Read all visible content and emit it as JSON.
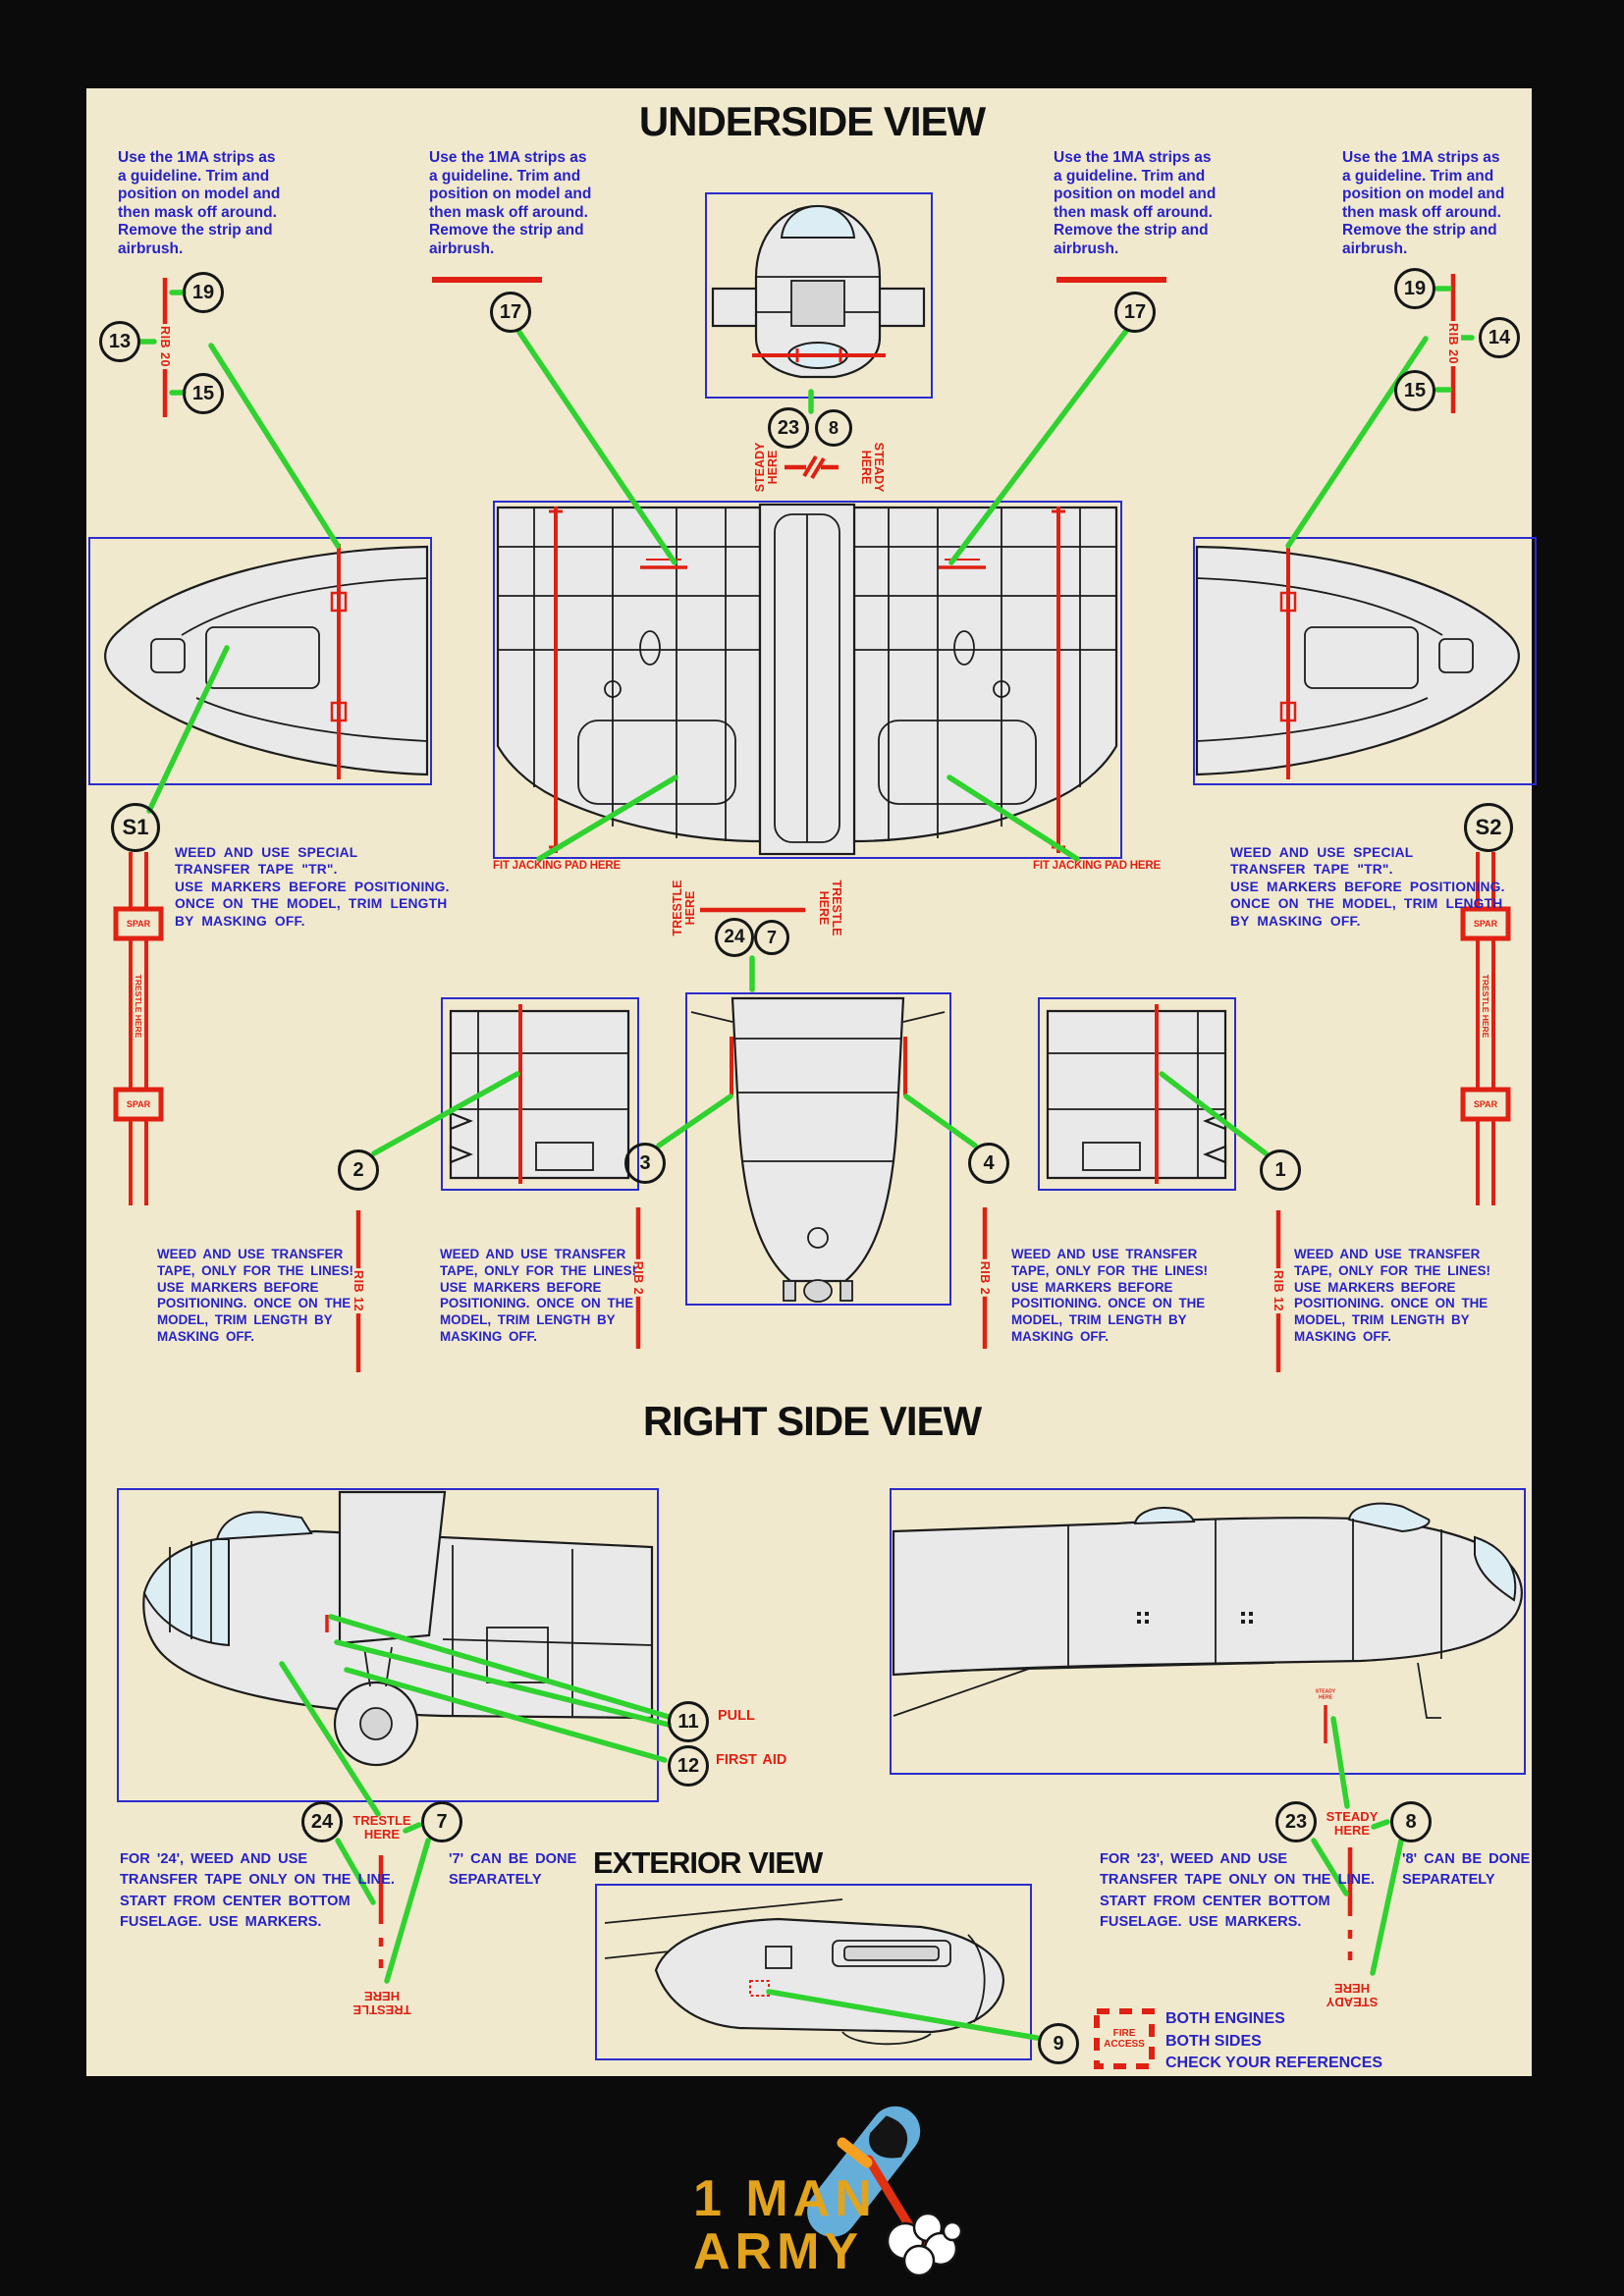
{
  "colors": {
    "paper": "#f0e9ce",
    "blue_text": "#2822c6",
    "box_border": "#2b2bcd",
    "red": "#e02012",
    "green": "#2fd22f",
    "black": "#141414",
    "logo_yellow": "#e2a31d",
    "logo_blue": "#64aed9"
  },
  "titles": {
    "underside": "UNDERSIDE VIEW",
    "right_side": "RIGHT SIDE VIEW",
    "exterior": "EXTERIOR VIEW"
  },
  "notes": {
    "strip_guideline": "Use the 1MA strips as\na guideline. Trim and\nposition on model and\nthen mask off around.\nRemove the strip and\nairbrush.",
    "weed_special": "WEED AND USE SPECIAL\nTRANSFER TAPE \"TR\".\nUSE MARKERS BEFORE POSITIONING.\nONCE ON THE MODEL, TRIM LENGTH\nBY MASKING OFF.",
    "weed_lines": "WEED AND USE TRANSFER\nTAPE, ONLY FOR THE LINES!\nUSE MARKERS BEFORE\nPOSITIONING. ONCE ON THE\nMODEL, TRIM LENGTH BY\nMASKING OFF.",
    "for_24": "FOR '24', WEED AND USE\nTRANSFER TAPE ONLY ON THE LINE.\nSTART FROM CENTER BOTTOM\nFUSELAGE. USE MARKERS.",
    "for_23": "FOR '23', WEED AND USE\nTRANSFER TAPE ONLY ON THE LINE.\nSTART FROM CENTER BOTTOM\nFUSELAGE. USE MARKERS.",
    "sep_7": "'7' CAN BE DONE\nSEPARATELY",
    "sep_8": "'8' CAN BE DONE\nSEPARATELY"
  },
  "labels": {
    "rib20": "RIB 20",
    "rib12": "RIB 12",
    "rib2": "RIB 2",
    "spar": "SPAR",
    "trestle_line": "TRESTLE HERE",
    "trestle_stack": "TRESTLE\nHERE",
    "steady_stack": "STEADY\nHERE",
    "fit_jacking": "FIT JACKING PAD HERE",
    "pull": "PULL",
    "first_aid": "FIRST AID",
    "fire_access": "FIRE\nACCESS"
  },
  "legend": {
    "l1": "BOTH ENGINES",
    "l2": "BOTH SIDES",
    "l3": "CHECK YOUR REFERENCES"
  },
  "markers": {
    "m1": "1",
    "m2": "2",
    "m3": "3",
    "m4": "4",
    "m7": "7",
    "m8": "8",
    "m9": "9",
    "m11": "11",
    "m12": "12",
    "m13": "13",
    "m14": "14",
    "m15": "15",
    "m17": "17",
    "m19": "19",
    "m23": "23",
    "m24": "24",
    "s1": "S1",
    "s2": "S2"
  },
  "logo": {
    "line1": "1 MAN",
    "line2": "ARMY"
  }
}
